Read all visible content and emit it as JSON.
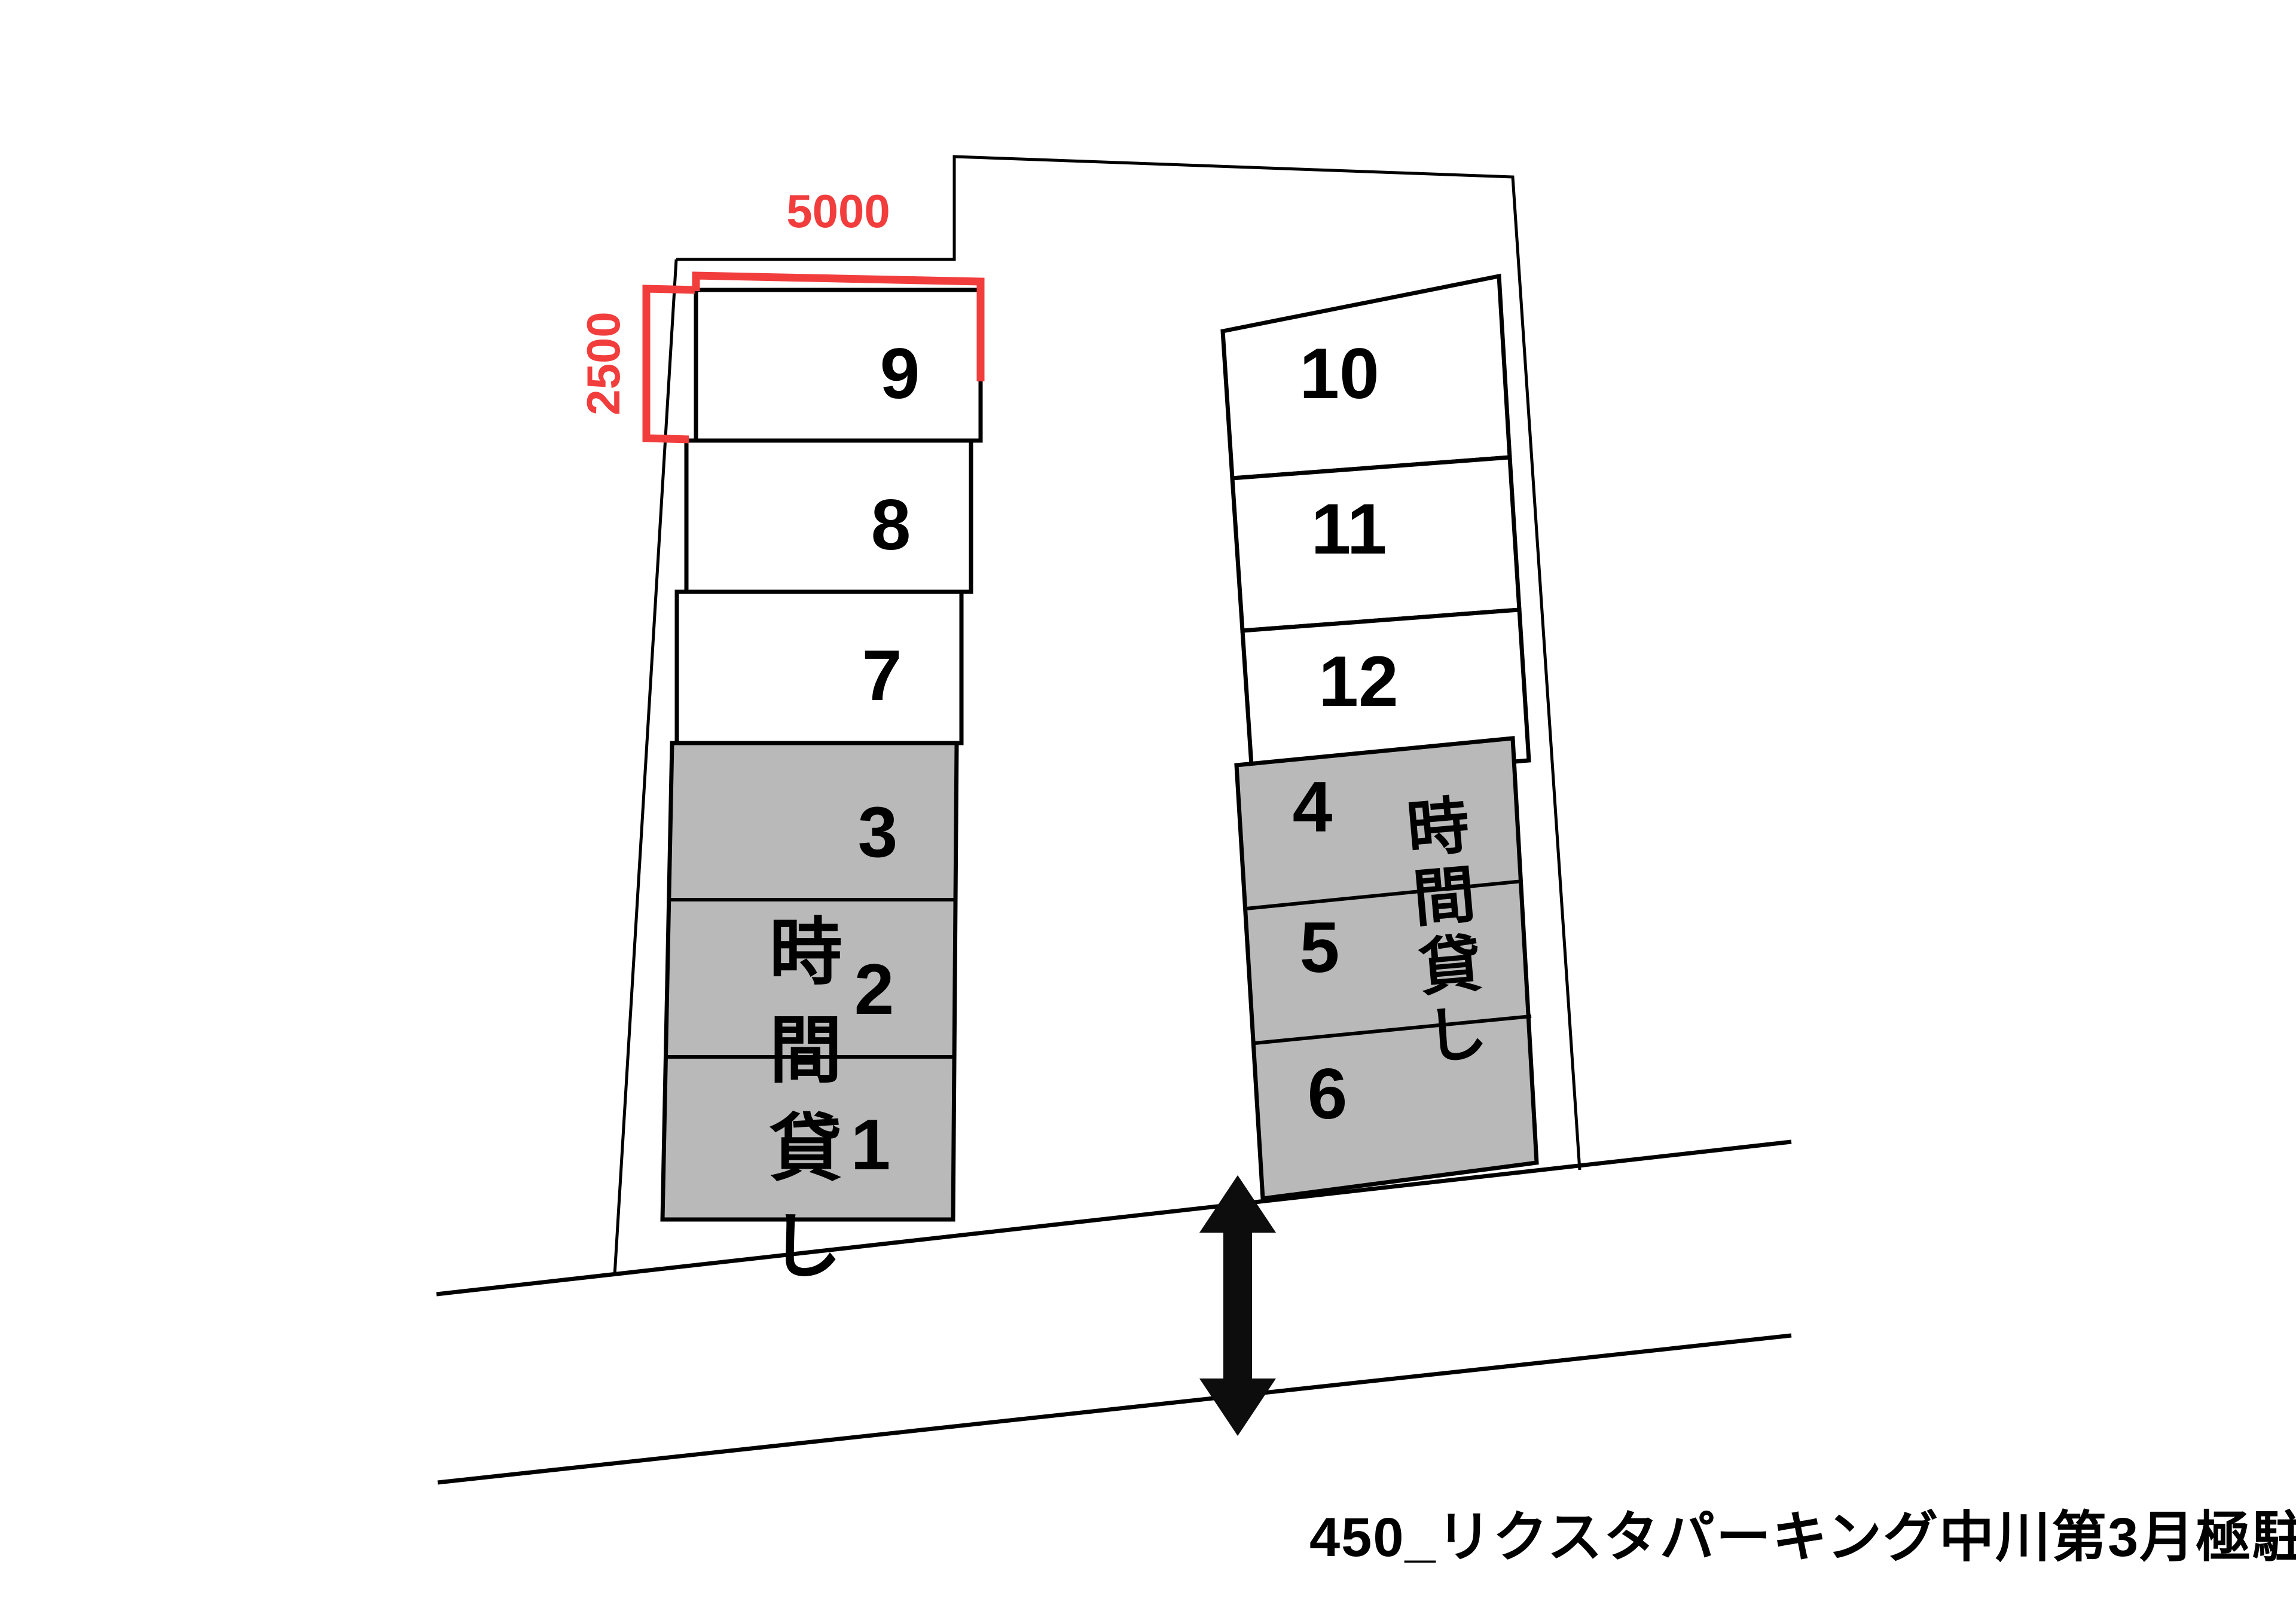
{
  "map": {
    "caption": "450_リクスタパーキング中川第3月極駐車場",
    "hourly_label": "時間貸し",
    "dimensions": {
      "width": "5000",
      "height": "2500"
    },
    "colors": {
      "accent_red": "#f23d3d",
      "stall_gray": "#b9b9b9",
      "line_black": "#000000"
    },
    "spaces": {
      "white_left": [
        "9",
        "8",
        "7"
      ],
      "hourly_left": [
        "3",
        "2",
        "1"
      ],
      "white_right": [
        "10",
        "11",
        "12"
      ],
      "hourly_right": [
        "4",
        "5",
        "6"
      ]
    }
  }
}
